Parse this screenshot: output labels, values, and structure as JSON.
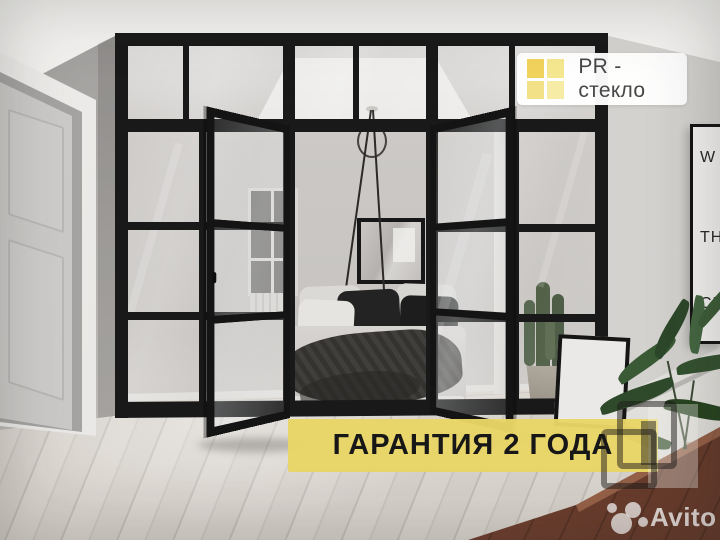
{
  "image": {
    "kind": "interior-photo-advert",
    "subject": "black steel framed glass partition with open glass doors in front of a bedroom"
  },
  "brand_badge": {
    "label": "PR - стекло",
    "icon": "window-grid",
    "background": "#ffffff",
    "text_color": "#474747",
    "pane_colors": [
      "#f0d25c",
      "#f5e790",
      "#f3e188",
      "#f6eca6"
    ]
  },
  "warranty_banner": {
    "label": "ГАРАНТИЯ 2 ГОДА",
    "background": "#e9d669",
    "text_color": "#171717"
  },
  "avito_watermark": {
    "label": "Avito",
    "color": "rgba(255,255,255,0.75)"
  },
  "wall_poster": {
    "lines": [
      "W",
      "TH",
      "CH"
    ]
  },
  "palette": {
    "frame_black": "#1a1a1a",
    "wall_gray": "#b7b5b2",
    "floor_wood": "#d7d2cb",
    "ottoman_brown": "#7c4936",
    "plant_green": "#35512f"
  }
}
